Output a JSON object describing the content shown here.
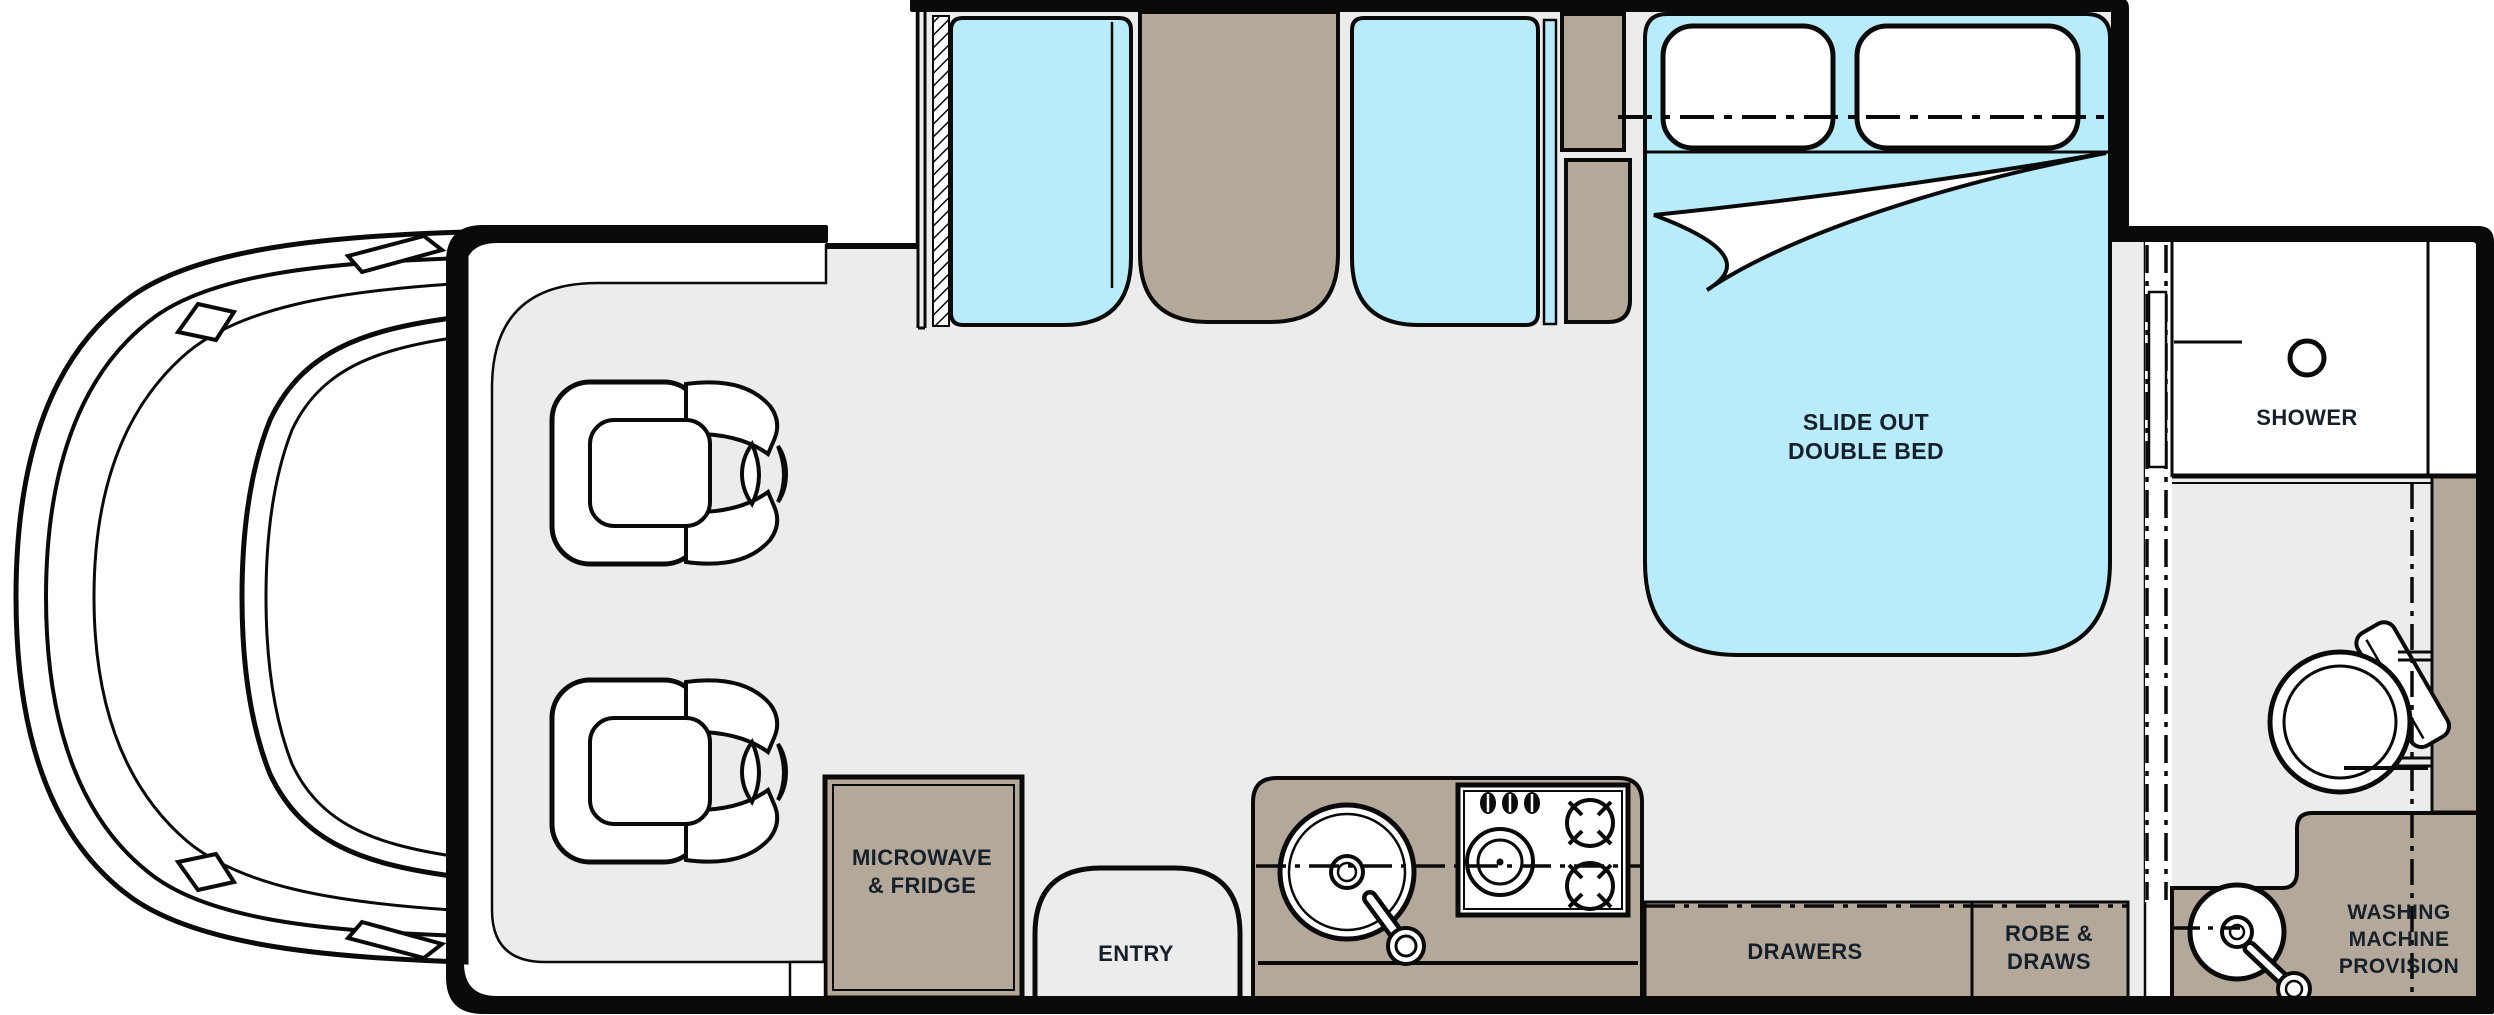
{
  "colors": {
    "wall": "#0a0a0a",
    "floor_gray": "#ececec",
    "cabinet_tan": "#b4a89b",
    "cushion_blue": "#b9ecfb",
    "shower_white": "#ffffff",
    "label_text": "#15202b"
  },
  "labels": {
    "slide_out_double_bed": "SLIDE OUT\nDOUBLE BED",
    "shower": "SHOWER",
    "microwave_fridge": "MICROWAVE\n& FRIDGE",
    "entry": "ENTRY",
    "drawers": "DRAWERS",
    "robe_draws": "ROBE &\nDRAWS",
    "washing_machine_provision": "WASHING\nMACHINE\nPROVISION"
  },
  "fixtures": [
    "cab-front",
    "swivel-chair-front",
    "swivel-chair-rear",
    "dinette-seat-left",
    "dinette-table",
    "dinette-seat-right",
    "slide-out-double-bed",
    "pillows",
    "wardrobe-cabinets",
    "microwave-fridge-cabinet",
    "entry-arch",
    "kitchen-sink",
    "cooktop",
    "drawers-cabinet",
    "robe-cabinet",
    "sliding-partition-door",
    "shower-room",
    "shower-head",
    "toilet",
    "bathroom-cabinet",
    "washing-machine-counter",
    "vanity-basin"
  ]
}
